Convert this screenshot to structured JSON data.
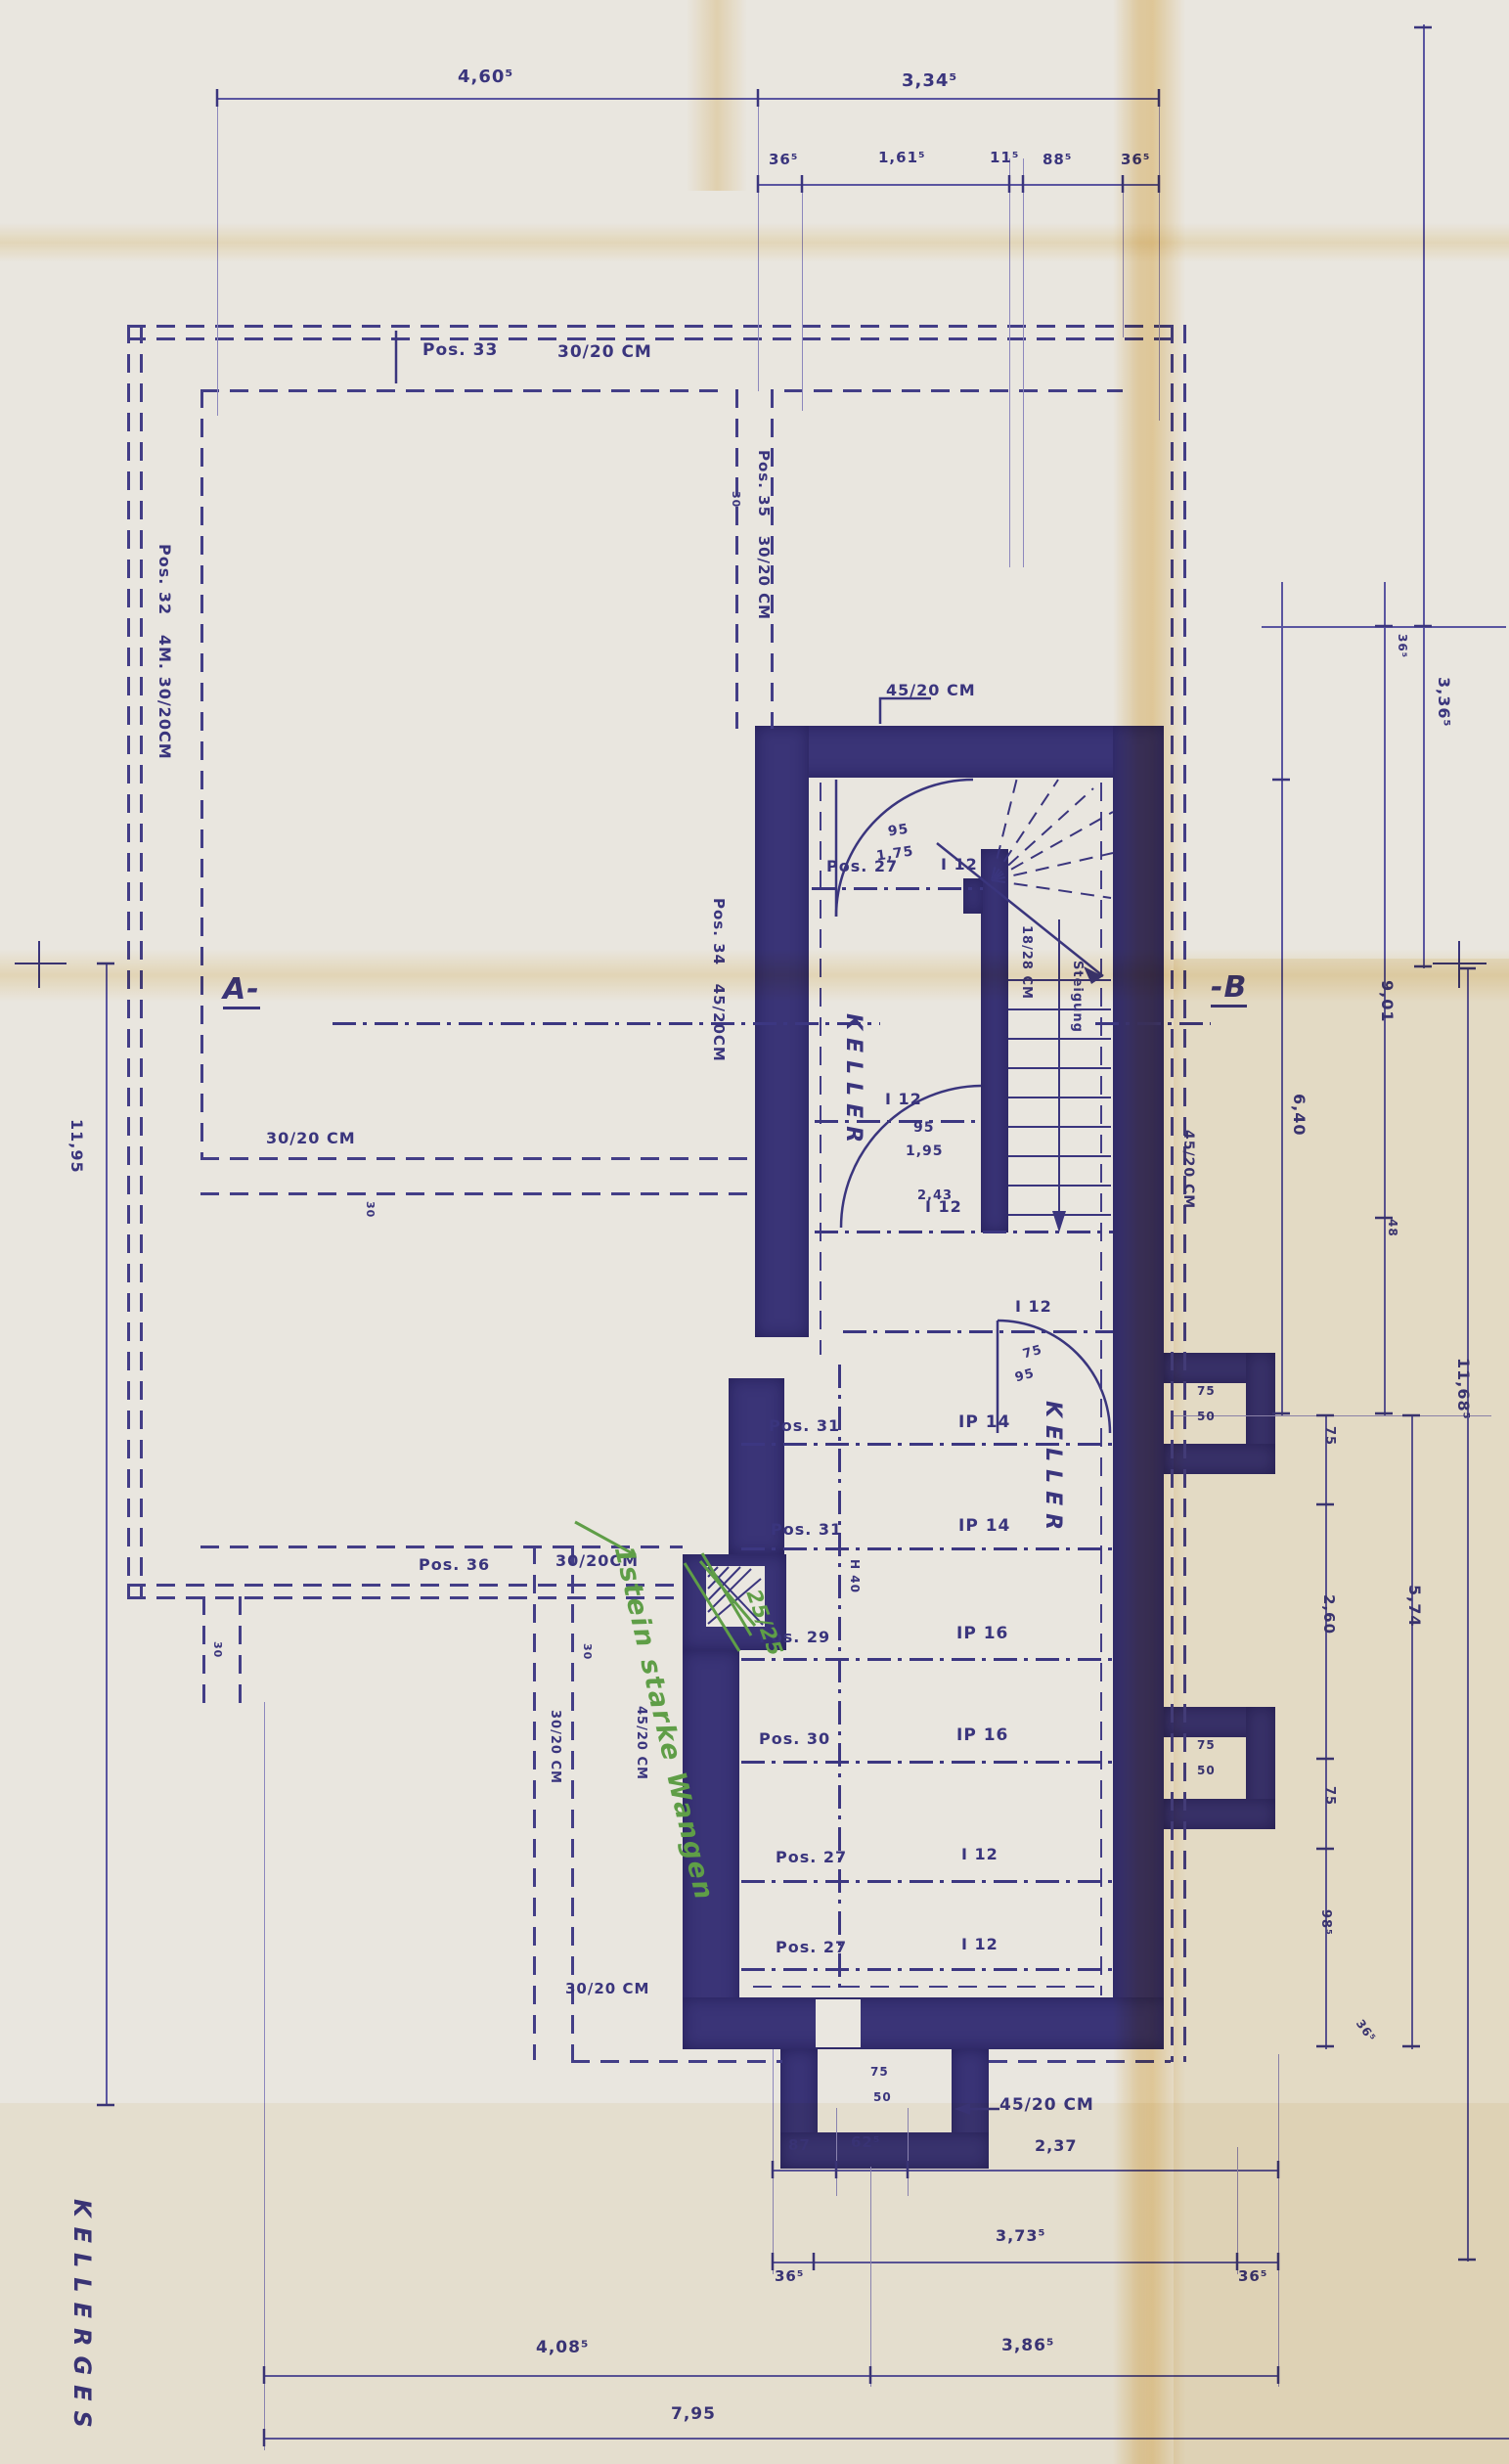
{
  "sheet": {
    "side_title": "KELLERGES",
    "colors": {
      "ink": "#3a357d",
      "wall_fill": "#3a3477",
      "green_note": "#5f9e47",
      "paper": "#e9e6df",
      "crease_yellow": "#e0b152"
    }
  },
  "dim": {
    "t1": "4,60⁵",
    "t2": "3,34⁵",
    "t3": "36⁵",
    "t4": "1,61⁵",
    "t5": "11⁵",
    "t6": "88⁵",
    "t7": "36⁵",
    "l1": "11,95",
    "r1": "3,36⁵",
    "r2": "36⁵",
    "r3": "9,01",
    "r4": "48",
    "r5": "6,40",
    "r6": "11,68⁵",
    "r7": "75",
    "r8": "2,60",
    "r9": "75",
    "r10": "98⁵",
    "r11": "5,74",
    "r12": "36⁵",
    "b1": "87",
    "b2": "62⁵",
    "b3": "2,37",
    "b4": "36⁵",
    "b5": "3,73⁵",
    "b6": "36⁵",
    "b7": "4,08⁵",
    "b8": "3,86⁵",
    "b9": "7,95",
    "m30": "30",
    "d243": "2,43"
  },
  "labels": {
    "pos33": "Pos. 33",
    "w3020": "30/20 CM",
    "w3020b": "30/20CM",
    "pos32": "Pos. 32   4M. 30/20CM",
    "pos35": "Pos. 35   30/20 CM",
    "pos34": "Pos. 34   45/20CM",
    "pos36": "Pos. 36",
    "w4520": "45/20 CM",
    "pos27": "Pos. 27",
    "pos29": "Pos. 29",
    "pos30": "Pos. 30",
    "pos31": "Pos. 31",
    "i12": "I 12",
    "ip14": "IP 14",
    "ip16": "IP 16",
    "keller": "KELLER",
    "riser": "18/28 CM",
    "steigung": "Steigung",
    "h40": "H 40",
    "door_a_w": "95",
    "door_a_h": "1,75",
    "door_b_w": "95",
    "door_b_h": "1,95",
    "door_c_w": "75",
    "door_c_h": "95",
    "shaft_w": "75",
    "shaft_h": "50",
    "sec_a": "A-",
    "sec_b": "-B"
  },
  "green": {
    "note": "1stein starke Wangen",
    "size": "25/25"
  }
}
